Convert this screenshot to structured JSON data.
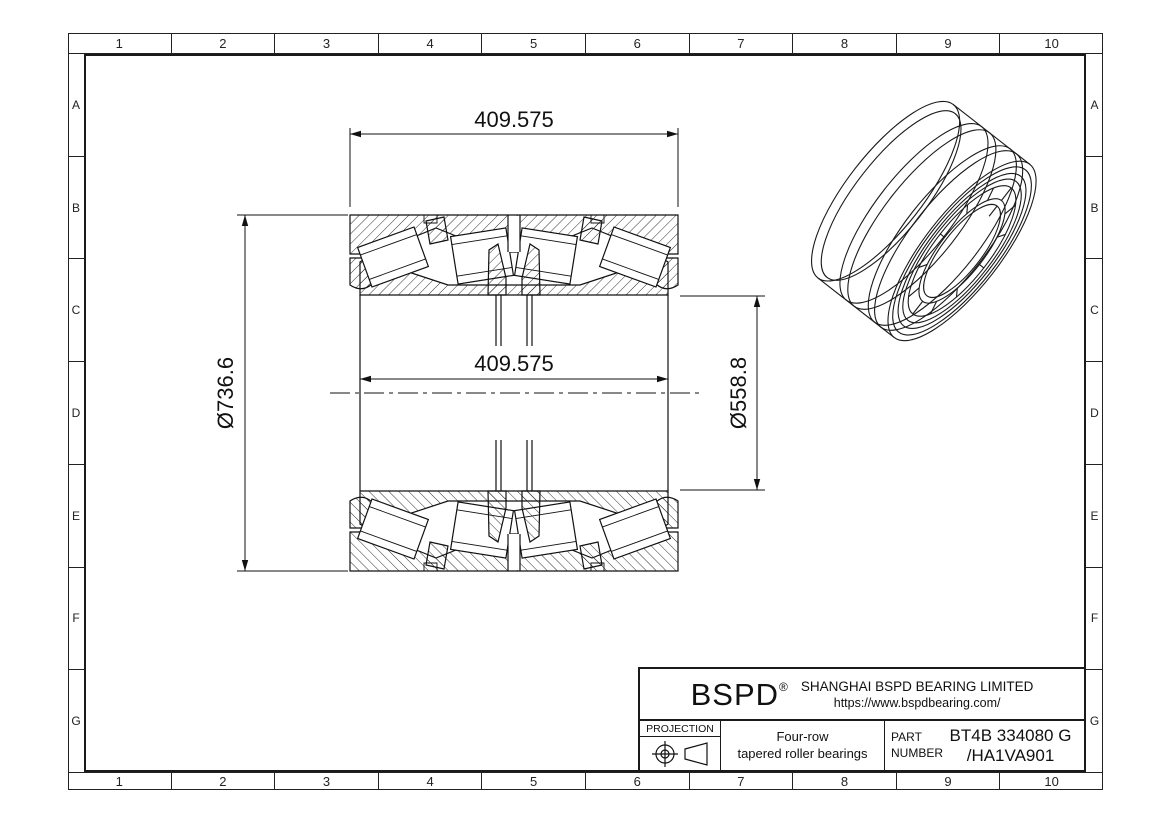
{
  "grid": {
    "cols": [
      "1",
      "2",
      "3",
      "4",
      "5",
      "6",
      "7",
      "8",
      "9",
      "10"
    ],
    "rows": [
      "A",
      "B",
      "C",
      "D",
      "E",
      "F",
      "G"
    ]
  },
  "dims": {
    "width_top": "409.575",
    "width_inner": "409.575",
    "outer_diameter": "Ø736.6",
    "inner_diameter": "Ø558.8"
  },
  "title_block": {
    "logo": "BSPD",
    "reg": "®",
    "company": "SHANGHAI BSPD BEARING LIMITED",
    "website": "https://www.bspdbearing.com/",
    "projection_label": "PROJECTION",
    "projection_icon": "first-angle-projection",
    "product_line1": "Four-row",
    "product_line2": "tapered roller bearings",
    "part_label_line1": "PART",
    "part_label_line2": "NUMBER",
    "part_number_line1": "BT4B 334080 G",
    "part_number_line2": "/HA1VA901"
  },
  "colors": {
    "line": "#111111",
    "background": "#ffffff"
  }
}
